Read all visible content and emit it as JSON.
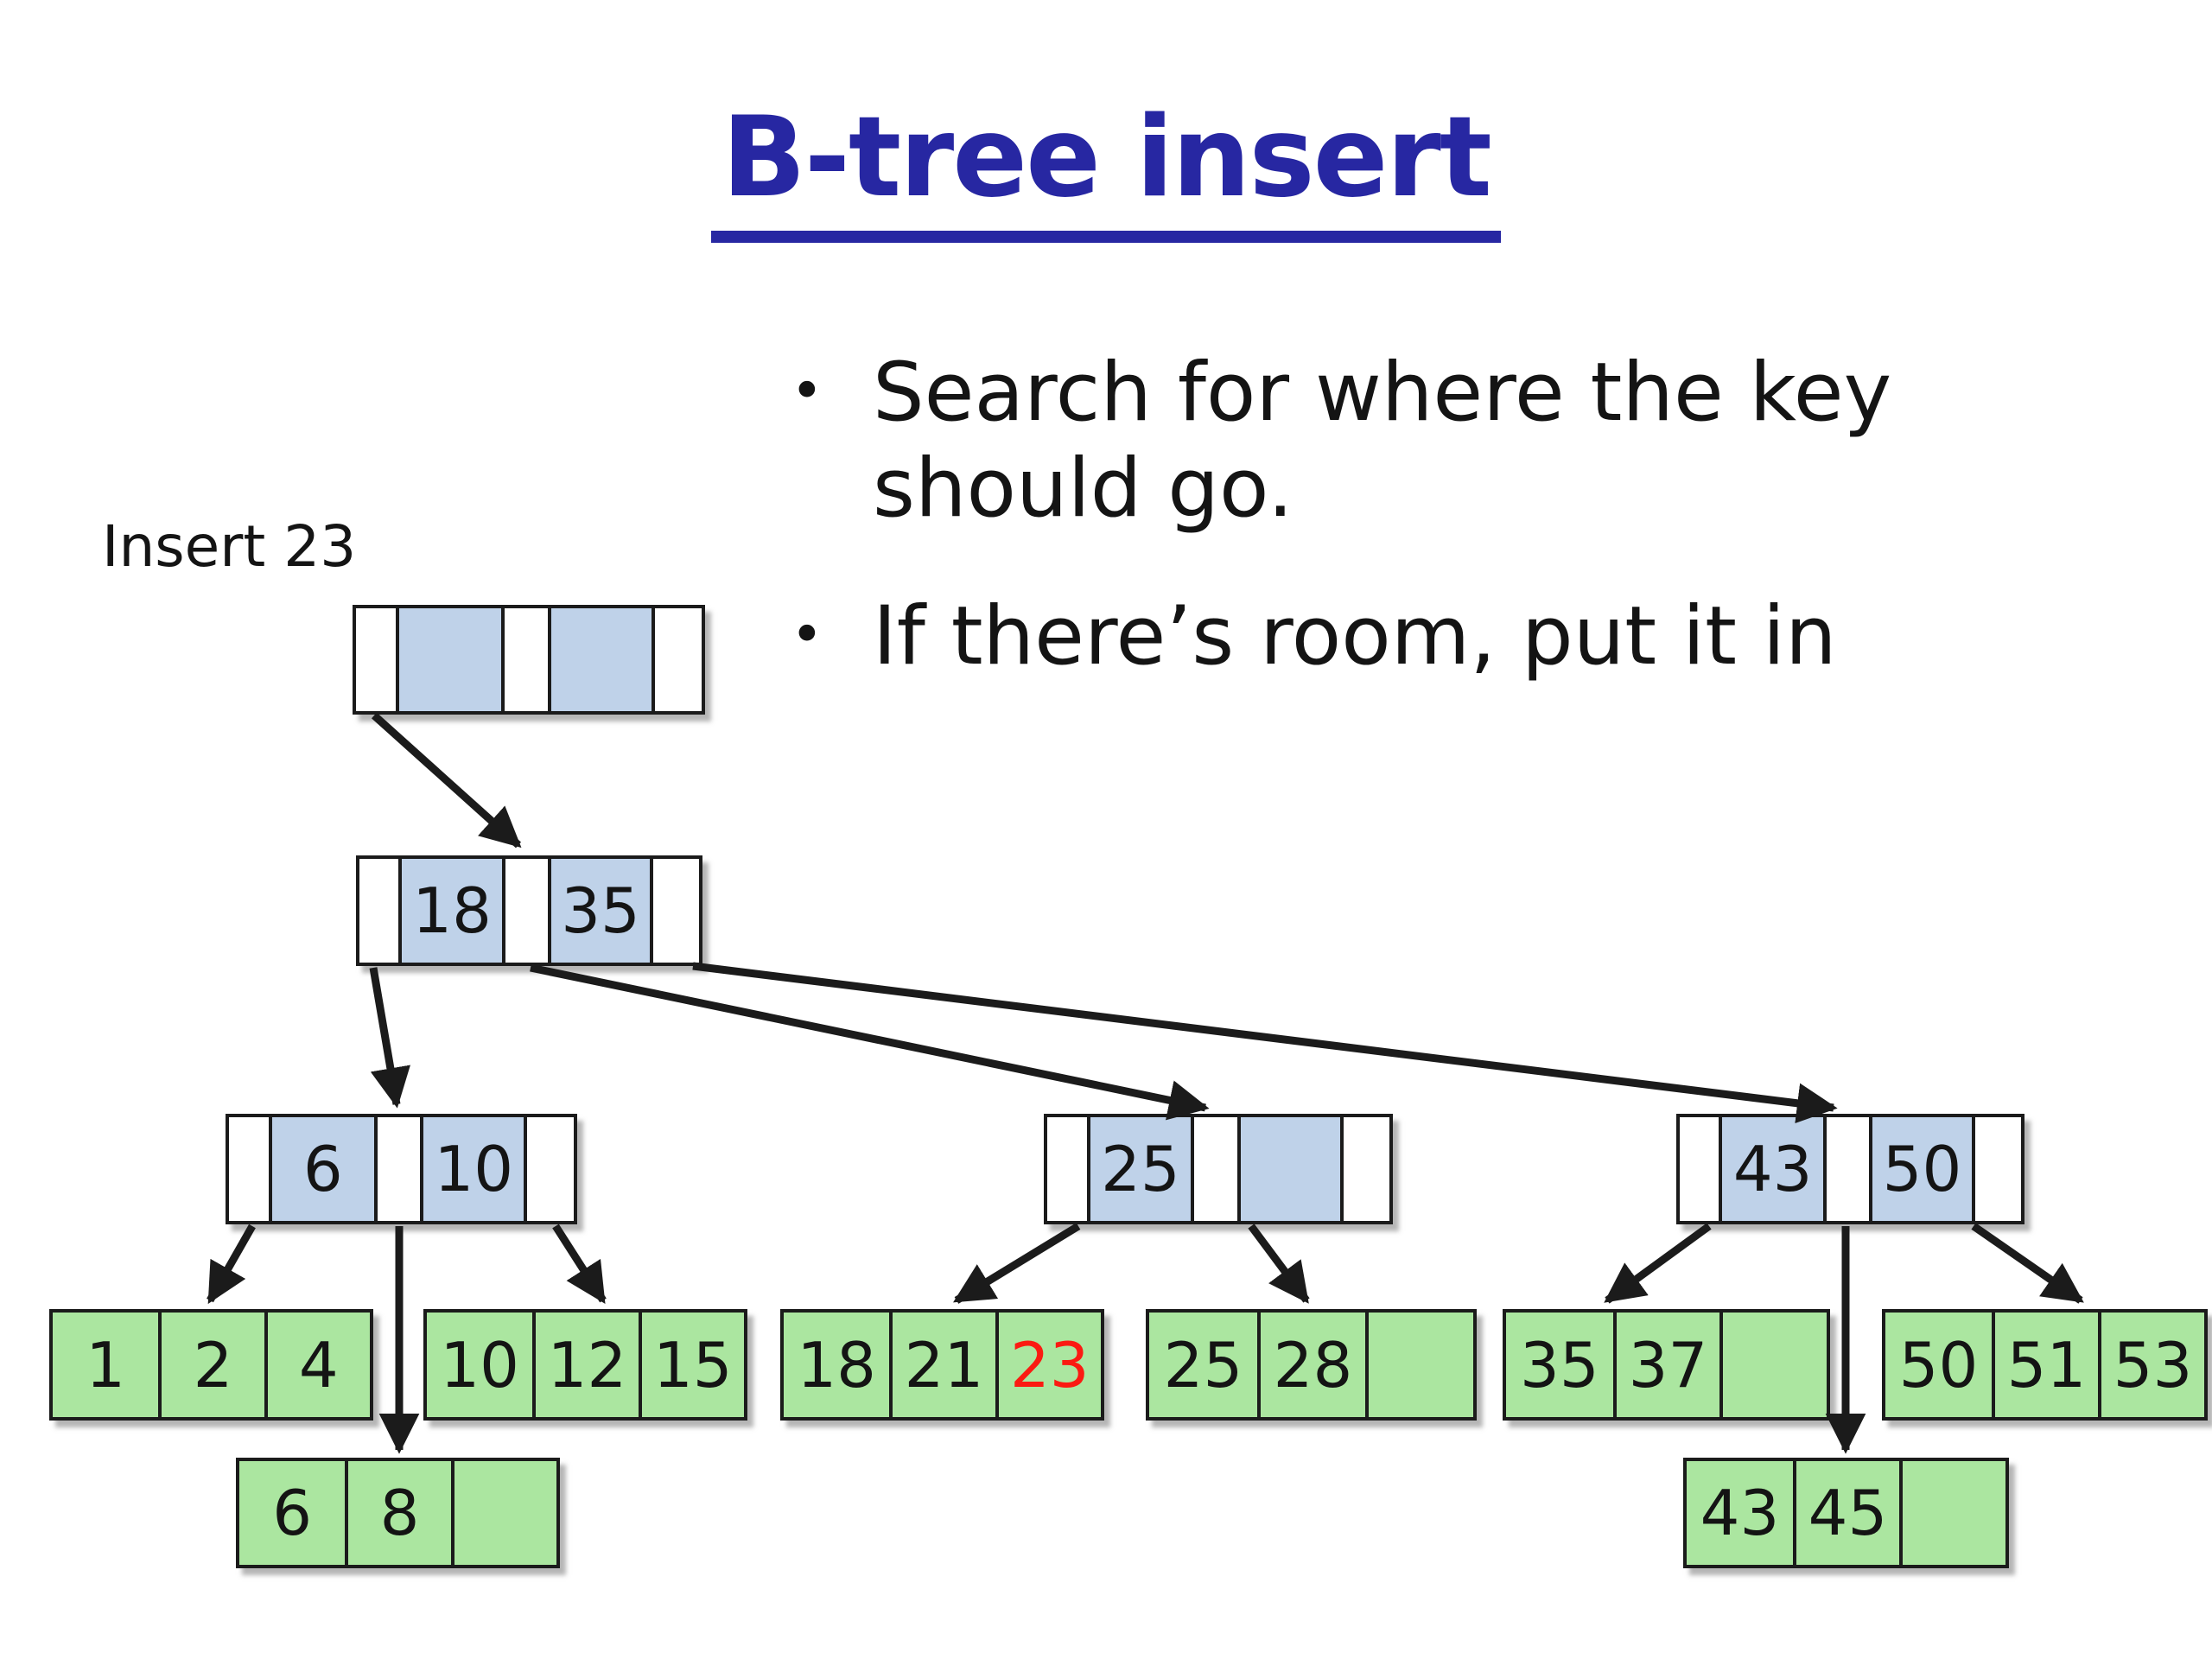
{
  "title": "B-tree insert",
  "bullet_glyph": "•",
  "bullets": [
    "Search for where the key should go.",
    "If there’s room, put it in"
  ],
  "annotation": "Insert 23",
  "colors": {
    "title_text": "#2727a2",
    "body_text": "#141414",
    "line": "#1b1b1b",
    "key_cell": "#bfd2e9",
    "leaf_cell": "#abe6a0",
    "highlight_text": "#fb1a12"
  },
  "tree": {
    "root": {
      "id": "root",
      "keys": [
        "",
        ""
      ]
    },
    "internal": [
      {
        "id": "node-18-35",
        "keys": [
          "18",
          "35"
        ]
      },
      {
        "id": "node-6-10",
        "keys": [
          "6",
          "10"
        ]
      },
      {
        "id": "node-25",
        "keys": [
          "25",
          ""
        ]
      },
      {
        "id": "node-43-50",
        "keys": [
          "43",
          "50"
        ]
      }
    ],
    "leaves": [
      {
        "id": "leaf-1-2-4",
        "keys": [
          "1",
          "2",
          "4"
        ]
      },
      {
        "id": "leaf-10-12-15",
        "keys": [
          "10",
          "12",
          "15"
        ]
      },
      {
        "id": "leaf-18-21-23",
        "keys": [
          "18",
          "21",
          "23"
        ],
        "highlight_index": 2
      },
      {
        "id": "leaf-25-28",
        "keys": [
          "25",
          "28",
          ""
        ]
      },
      {
        "id": "leaf-35-37",
        "keys": [
          "35",
          "37",
          ""
        ]
      },
      {
        "id": "leaf-50-51-53",
        "keys": [
          "50",
          "51",
          "53"
        ]
      },
      {
        "id": "leaf-6-8",
        "keys": [
          "6",
          "8",
          ""
        ]
      },
      {
        "id": "leaf-43-45",
        "keys": [
          "43",
          "45",
          ""
        ]
      }
    ],
    "edges": [
      {
        "from": "root",
        "to": "node-18-35"
      },
      {
        "from": "node-18-35",
        "to": "node-6-10"
      },
      {
        "from": "node-18-35",
        "to": "node-25"
      },
      {
        "from": "node-18-35",
        "to": "node-43-50"
      },
      {
        "from": "node-6-10",
        "to": "leaf-1-2-4"
      },
      {
        "from": "node-6-10",
        "to": "leaf-6-8"
      },
      {
        "from": "node-6-10",
        "to": "leaf-10-12-15"
      },
      {
        "from": "node-25",
        "to": "leaf-18-21-23"
      },
      {
        "from": "node-25",
        "to": "leaf-25-28"
      },
      {
        "from": "node-43-50",
        "to": "leaf-35-37"
      },
      {
        "from": "node-43-50",
        "to": "leaf-43-45"
      },
      {
        "from": "node-43-50",
        "to": "leaf-50-51-53"
      }
    ]
  }
}
